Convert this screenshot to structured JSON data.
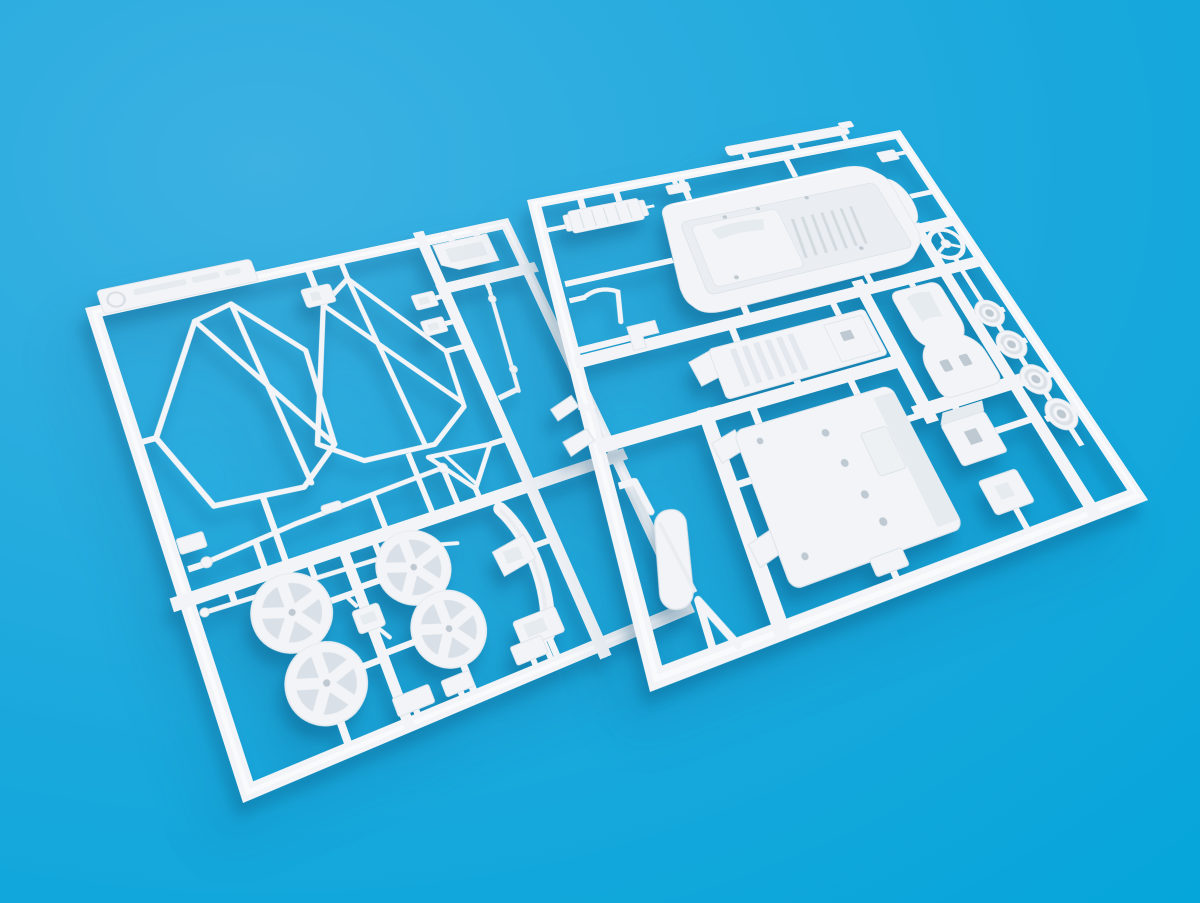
{
  "scene": {
    "type": "photograph",
    "subject": "Two white injection-molded plastic model-kit sprues (parts trees) on a blue background",
    "background": {
      "color_top_left": "#3CB1E2",
      "color_mid": "#19A8DC",
      "color_bottom_right": "#00A5DA"
    },
    "plastic": {
      "color": "#F2F4F7",
      "edge_color": "#E0E6EC",
      "recess_color": "#D9E0E7",
      "hole_color": "#BFC9D2",
      "shadow_color": "rgba(3,70,110,0.30)"
    },
    "sprues": [
      {
        "id": "sprue-left",
        "position": "lower-left, tilted",
        "parts": [
          "molded-label-plate",
          "circle-stamp",
          "roll-cage-side-frame-left",
          "roll-cage-side-frame-right",
          "bracket-clip-pair",
          "rectangular-plate",
          "long-link-rod",
          "anti-roll-bar",
          "tie-rod",
          "five-spoke-wheel-x4",
          "axle-coupler",
          "windshield-frame-strip",
          "triangular-brace",
          "mounting-bracket",
          "base-plate",
          "small-plates-x3",
          "left-rail-tab"
        ]
      },
      {
        "id": "sprue-right",
        "position": "upper-right, tilted",
        "parts": [
          "engine-cover-rear-deck",
          "side-sill-strip",
          "finned-cooler",
          "corner-fitting",
          "small-fitting",
          "steering-wheel",
          "bucket-seat",
          "dashboard-bulkhead",
          "chassis-floor-pan",
          "disc-pulley-x4",
          "gearbox-box",
          "small-housing-box",
          "exhaust-muffler",
          "door-mirror-x2",
          "linkage-hook",
          "l-bracket"
        ]
      }
    ]
  }
}
